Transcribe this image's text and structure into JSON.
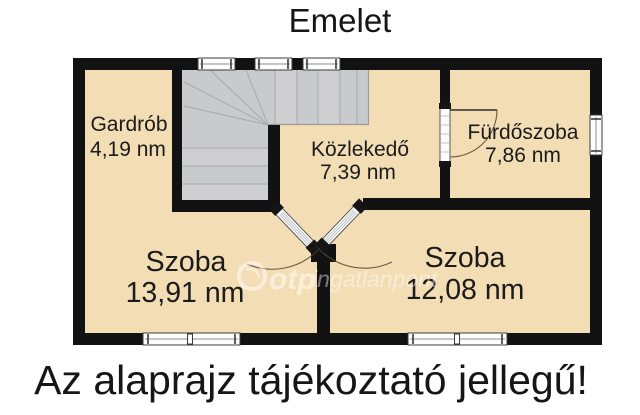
{
  "title": "Emelet",
  "disclaimer": "Az alaprajz tájékoztató jellegű!",
  "watermark": {
    "logo": "otp",
    "text": "ingatlanpont"
  },
  "rooms": {
    "gardrob": {
      "name": "Gardrób",
      "area": "4,19 nm"
    },
    "kozlekedo": {
      "name": "Közlekedő",
      "area": "7,39 nm"
    },
    "furdoszoba": {
      "name": "Fürdőszoba",
      "area": "7,86 nm"
    },
    "szoba_left": {
      "name": "Szoba",
      "area": "13,91 nm"
    },
    "szoba_right": {
      "name": "Szoba",
      "area": "12,08 nm"
    }
  },
  "colors": {
    "floor": "#f3ddb4",
    "wall": "#121212",
    "stairs": "#c9cacc",
    "text": "#161616",
    "watermark": "#ffffff"
  }
}
